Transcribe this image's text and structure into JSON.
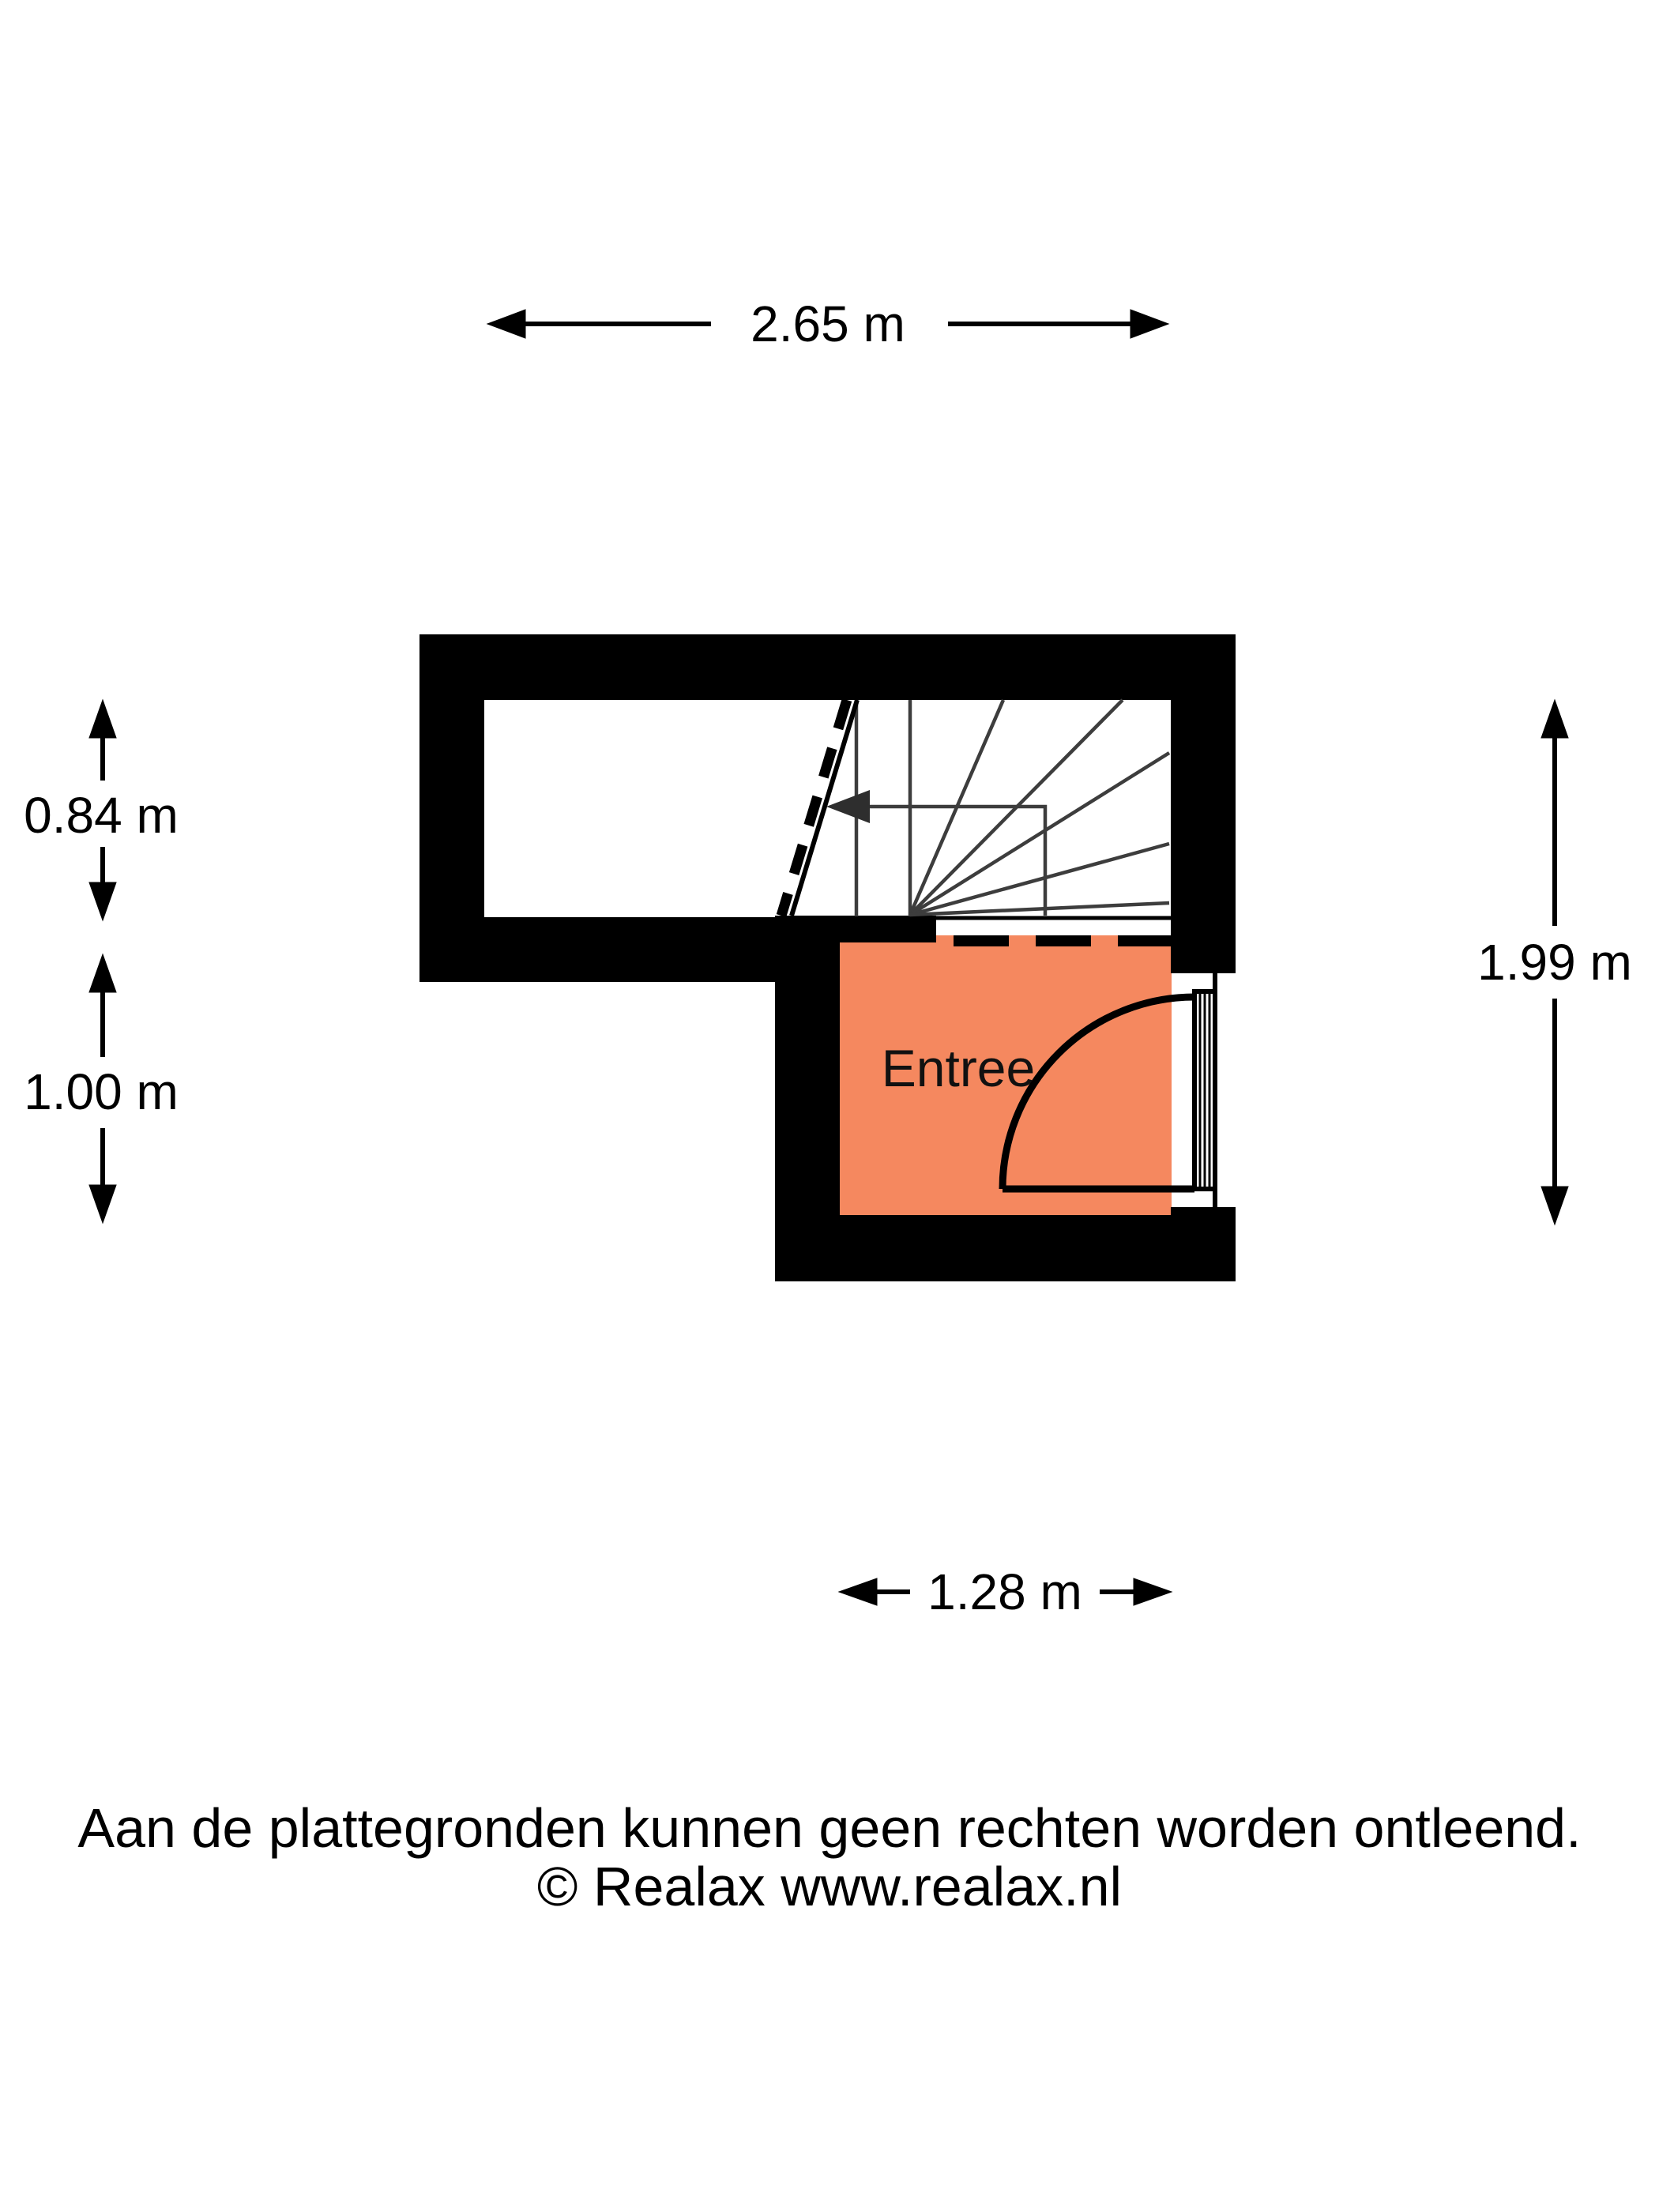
{
  "floorplan": {
    "room": {
      "label": "Entree",
      "color": "#F5885F"
    },
    "wall_color": "#000000",
    "stair_line_color": "#3d3d3d",
    "dimensions": {
      "top_width": "2.65 m",
      "stair_depth": "0.84 m",
      "entree_depth": "1.00 m",
      "right_height": "1.99 m",
      "entree_width": "1.28 m"
    }
  },
  "footer": {
    "disclaimer": "Aan de plattegronden kunnen geen rechten worden ontleend.",
    "copyright": "© Realax www.realax.nl"
  }
}
